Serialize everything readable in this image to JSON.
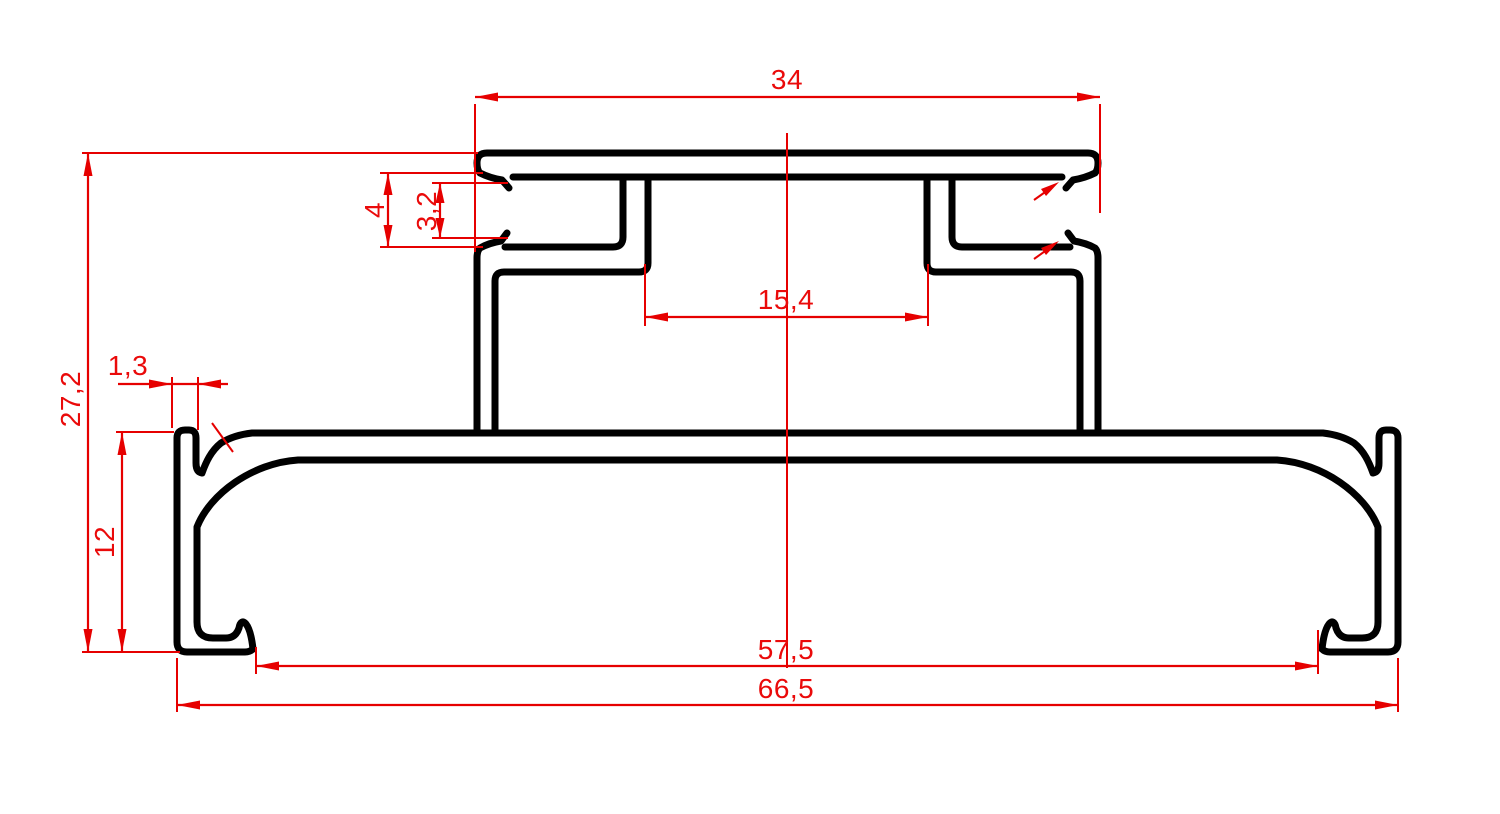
{
  "drawing": {
    "type": "technical-profile-cross-section",
    "background_color": "#ffffff",
    "outline_color": "#000000",
    "dimension_color": "#e60000",
    "dimensions": {
      "top_width": "34",
      "groove_mouth_outer": "4",
      "groove_mouth_inner": "3,2",
      "neck_opening": "15,4",
      "total_height": "27,2",
      "edge_wall_thickness": "1,3",
      "base_height": "12",
      "base_inner_span": "57,5",
      "overall_width": "66,5"
    }
  }
}
